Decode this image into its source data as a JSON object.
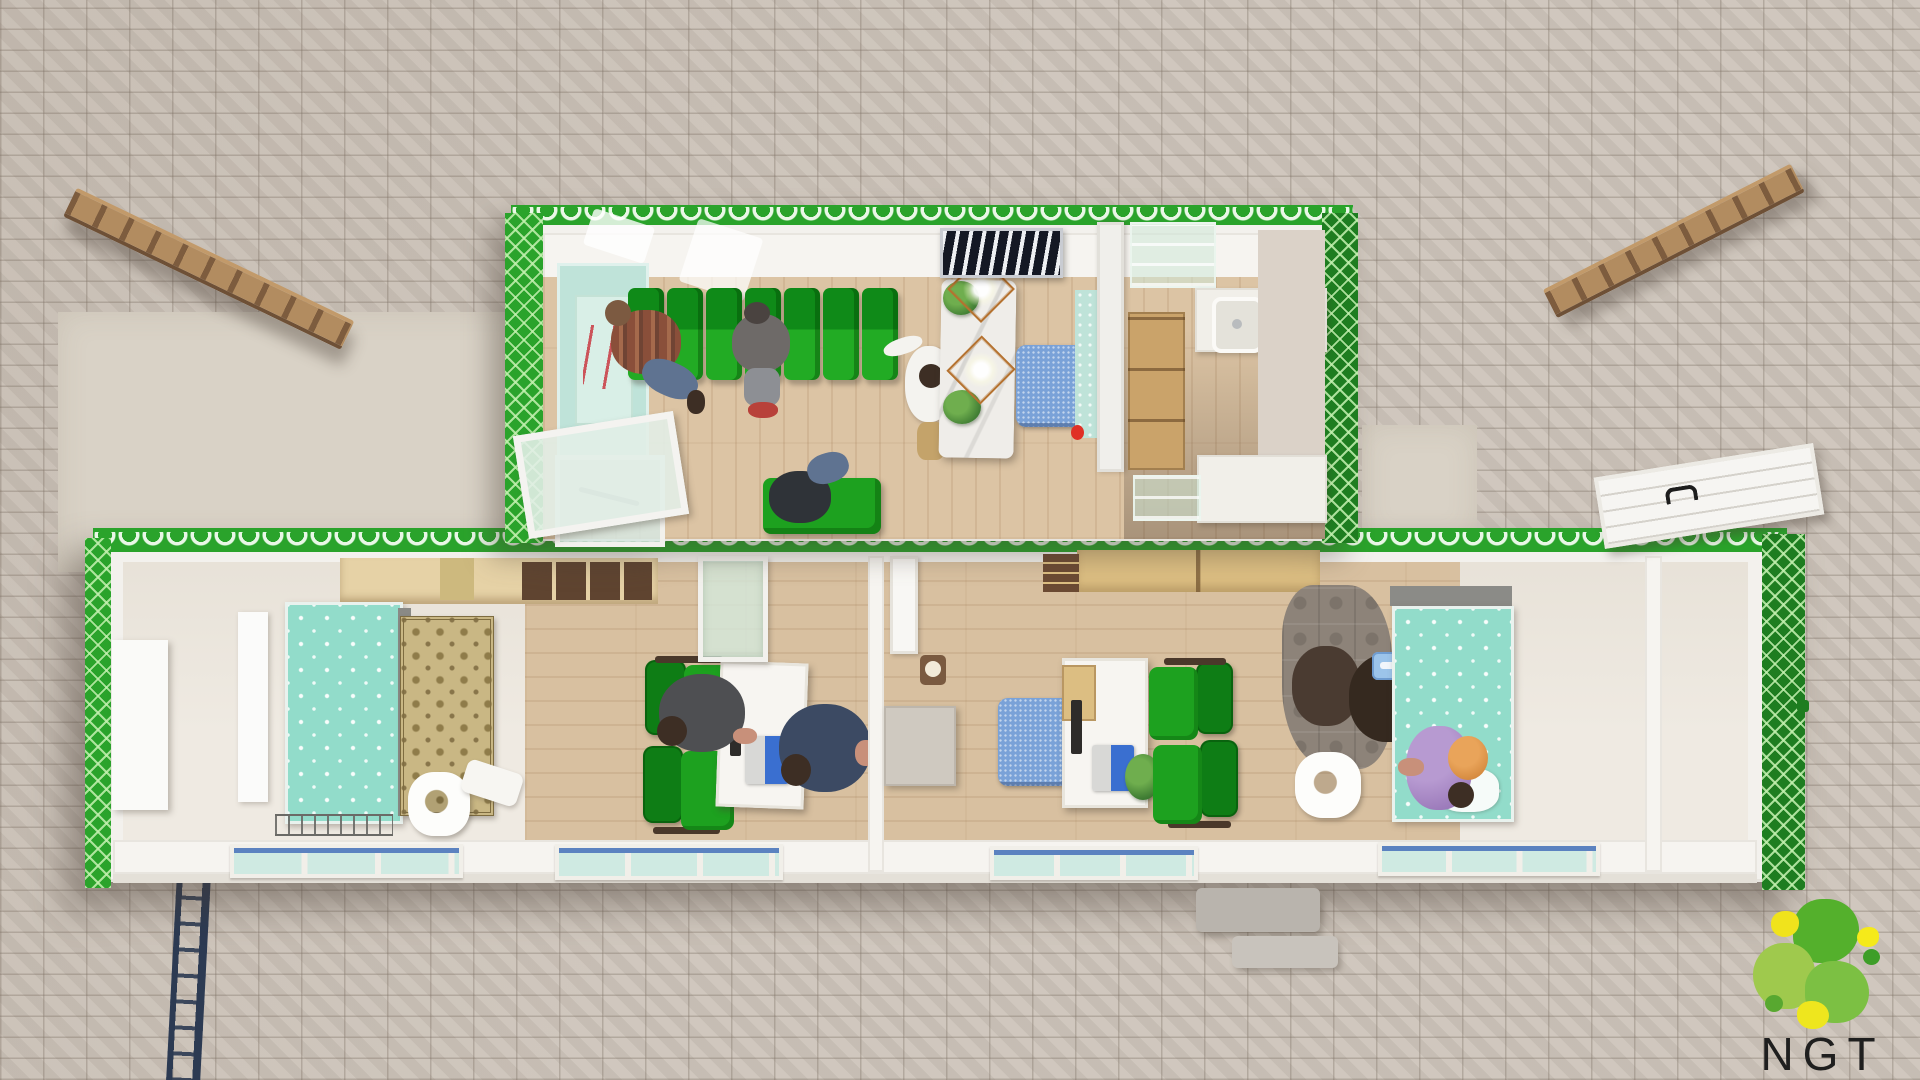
{
  "logo": {
    "text": "NGT",
    "blob_colors": [
      "#54b02c",
      "#9fc94d",
      "#7cc043",
      "#f0e31c",
      "#f5ea1a",
      "#3d9e28",
      "#eee61e",
      "#58a830"
    ]
  },
  "palette": {
    "container_green": "#2aa32b",
    "container_green_dark": "#1e7d20",
    "wall_white": "#f3f1ed",
    "wood_floor": "#dcc4a4",
    "wood_floor_lower": "#d8c0a0",
    "mint_wall": "#bfe3d9",
    "teal_bed": "#92dcca",
    "denim_blue": "#7aa2d8",
    "chair_green": "#1da11f",
    "marble": "#efede9",
    "copper": "#b5722f",
    "rug_gold": "#c9b784",
    "puzzle_gray": "#8d8379",
    "cabinet_tan": "#dcbe82",
    "extinguisher_red": "#e03025",
    "paver": "#cdc4ba",
    "concrete_pad": "#d9d2c6"
  },
  "scene": {
    "view": "top-down 3d render of two modular container buildings on a paver plaza",
    "ground": {
      "surface": "herringbone pavers",
      "props": [
        "concrete apron",
        "wooden ramp upper-left",
        "wooden ramp upper-right",
        "ladder lower-left",
        "outdoor tables"
      ]
    },
    "modules": [
      {
        "id": "module-top",
        "label": "reception and kitchenette unit",
        "features": [
          "green scalloped trim",
          "entry glass door",
          "mint signage wall with red script poster",
          "row of green waiting chairs",
          "ceiling light strips",
          "reception marble counter",
          "copper cage pendant lights",
          "potted plants",
          "zebra wall art",
          "denim office chair",
          "frosted partition",
          "fire extinguisher",
          "kitchenette sink",
          "glass shelves",
          "wood cabinet"
        ]
      },
      {
        "id": "module-bottom",
        "label": "exam and office unit",
        "features": [
          "green scalloped trim",
          "overhead cabinets",
          "wardrobe",
          "teal exam bed",
          "persian rug",
          "white infant scale",
          "office desk with monitor and laptop",
          "green task chairs",
          "corridor partition",
          "frosted interior window",
          "interior door",
          "paper dispenser",
          "gray cabinet",
          "denim task chair",
          "desk with laptop and plant",
          "gray foam play mat",
          "teal exam bed with pillow",
          "storage room",
          "bottom wall windows",
          "open roof hatch door"
        ]
      }
    ],
    "people": [
      {
        "id": "visitor-plaid",
        "desc": "seated visitor in plaid shirt"
      },
      {
        "id": "visitor-hoodie",
        "desc": "seated visitor in gray hoodie"
      },
      {
        "id": "visitor-bench",
        "desc": "visitor lying on green bench"
      },
      {
        "id": "receptionist-standing",
        "desc": "standing man in white shirt"
      },
      {
        "id": "clinician-gray",
        "desc": "clinician at left desk"
      },
      {
        "id": "visitor-navy",
        "desc": "visitor beside left desk"
      },
      {
        "id": "caregiver-one",
        "desc": "caregiver on play mat"
      },
      {
        "id": "caregiver-two",
        "desc": "caregiver holding blue tablet"
      },
      {
        "id": "patient-purple",
        "desc": "person in lilac dress at exam bed"
      }
    ]
  }
}
